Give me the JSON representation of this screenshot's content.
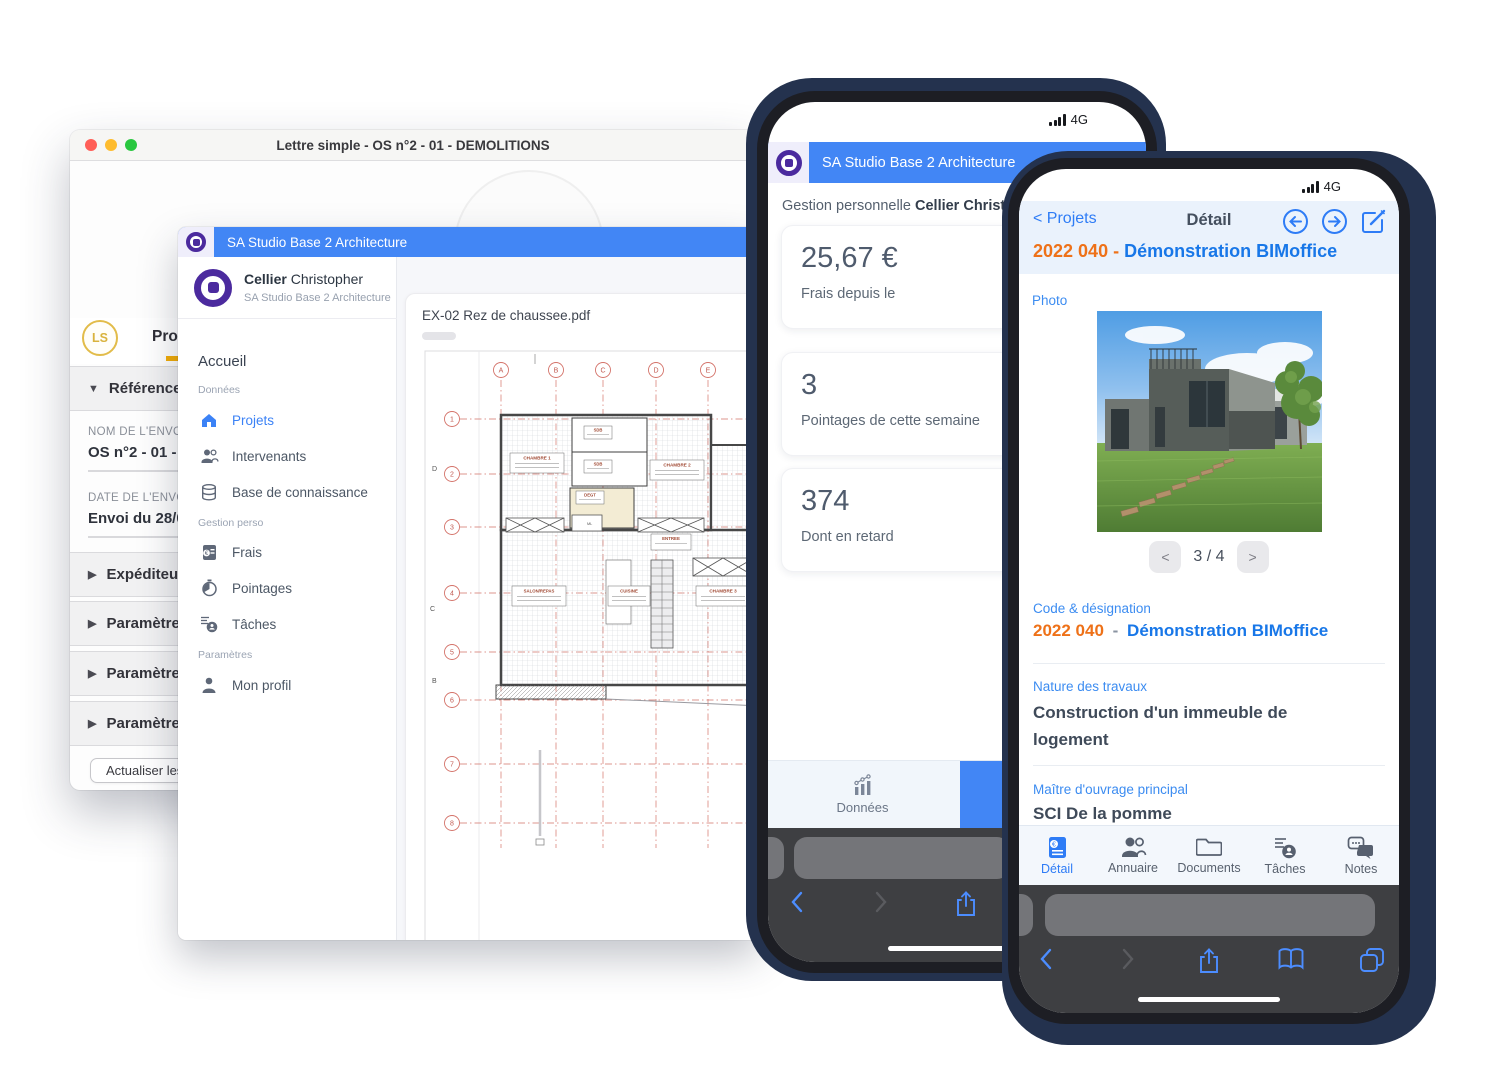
{
  "colors": {
    "brand_blue": "#4286F5",
    "brand_purple": "#4B2A9E",
    "accent_orange": "#EE7118",
    "link_blue": "#2E7CF6",
    "gold_accent": "#F3AC05",
    "plan_red": "#D4736A"
  },
  "mac_window": {
    "title": "Lettre simple - OS n°2 - 01 - DEMOLITIONS",
    "avatar_badge": "LS",
    "tab": "Prop",
    "accordion_open": "Références",
    "field1_label": "NOM DE L'ENVOI",
    "field1_value": "OS n°2 - 01 - DEMOLITIONS",
    "field2_label": "DATE DE L'ENVOI",
    "field2_value": "Envoi du 28/02/",
    "accordion1": "Expéditeur",
    "accordion2": "Paramètres",
    "accordion3": "Paramètres",
    "accordion4": "Paramètres",
    "action_button": "Actualiser les"
  },
  "desktop_app": {
    "header_title": "SA Studio Base 2 Architecture",
    "user_first": "Cellier",
    "user_last": "Christopher",
    "user_org": "SA Studio Base 2 Architecture",
    "nav_home": "Accueil",
    "section1": "Données",
    "item_projets": "Projets",
    "item_intervenants": "Intervenants",
    "item_base": "Base de connaissance",
    "section2": "Gestion perso",
    "item_frais": "Frais",
    "item_pointages": "Pointages",
    "item_taches": "Tâches",
    "section3": "Paramètres",
    "item_profil": "Mon profil",
    "doc_title": "EX-02 Rez de chaussee.pdf",
    "plan": {
      "cols": [
        "A",
        "B",
        "C",
        "D",
        "E"
      ],
      "rows": [
        "1",
        "2",
        "3",
        "4",
        "5",
        "6",
        "7",
        "8"
      ],
      "elev": [
        "D",
        "C",
        "B"
      ],
      "rooms": [
        "CHAMBRE 1",
        "SDB",
        "SDB",
        "CHAMBRE 2",
        "DEGT",
        "ENTREE",
        "SALON/REPAS",
        "CUISINE",
        "CHAMBRE 3",
        "ML"
      ]
    }
  },
  "phone1": {
    "network": "4G",
    "header_title": "SA Studio Base 2 Architecture",
    "greeting_prefix": "Gestion personnelle ",
    "greeting_name": "Cellier Christopher",
    "card1_value": "25,67 €",
    "card1_label": "Frais depuis le",
    "card2_value": "3",
    "card2_label": "Pointages de cette semaine",
    "card3_value": "374",
    "card3_label": "Dont en retard",
    "tab_donnees": "Données"
  },
  "phone2": {
    "network": "4G",
    "back_link": "Projets",
    "nav_title": "Détail",
    "header_code": "2022 040",
    "header_sep": "-",
    "header_name": "Démonstration BIMoffice",
    "photo_label": "Photo",
    "pager_prev": "<",
    "pager_value": "3 / 4",
    "pager_next": ">",
    "f1_label": "Code & désignation",
    "f1_code": "2022 040",
    "f1_sep": "-",
    "f1_name": "Démonstration BIMoffice",
    "f2_label": "Nature des travaux",
    "f2_value": "Construction d'un immeuble de logement",
    "f3_label": "Maître d'ouvrage principal",
    "f3_value": "SCI De la pomme",
    "tab1": "Détail",
    "tab2": "Annuaire",
    "tab3": "Documents",
    "tab4": "Tâches",
    "tab5": "Notes"
  }
}
